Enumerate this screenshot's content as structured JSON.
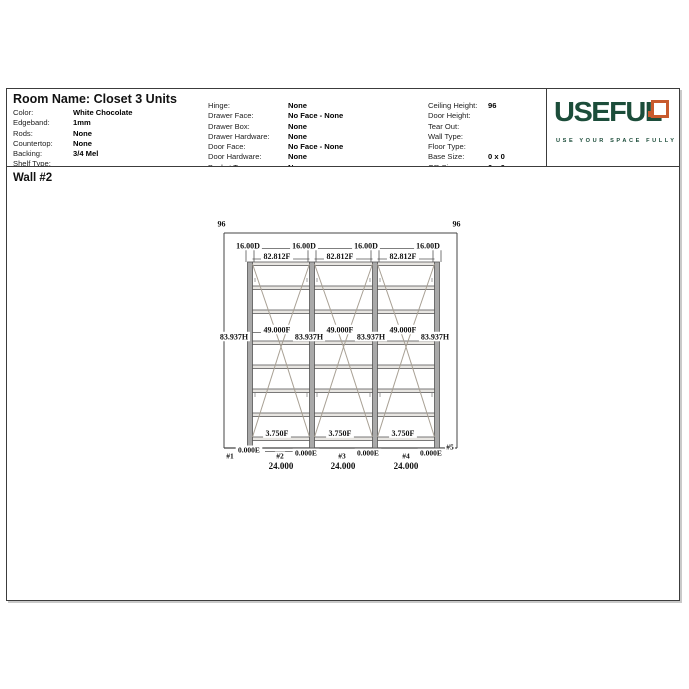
{
  "header": {
    "title": "Room Name: Closet 3 Units",
    "col1": [
      {
        "label": "Color:",
        "value": "White Chocolate"
      },
      {
        "label": "Edgeband:",
        "value": "1mm"
      },
      {
        "label": "Rods:",
        "value": "None"
      },
      {
        "label": "Countertop:",
        "value": "None"
      },
      {
        "label": "Backing:",
        "value": "3/4 Mel"
      },
      {
        "label": "Shelf Type:",
        "value": ""
      }
    ],
    "col2": [
      {
        "label": "Hinge:",
        "value": "None"
      },
      {
        "label": "Drawer Face:",
        "value": "No Face - None"
      },
      {
        "label": "Drawer Box:",
        "value": "None"
      },
      {
        "label": "Drawer Hardware:",
        "value": "None"
      },
      {
        "label": "Door Face:",
        "value": "No Face - None"
      },
      {
        "label": "Door Hardware:",
        "value": "None"
      },
      {
        "label": "Basket Type:",
        "value": "None"
      }
    ],
    "col3": [
      {
        "label": "Ceiling Height:",
        "value": "96"
      },
      {
        "label": "Door Height:",
        "value": ""
      },
      {
        "label": "Tear Out:",
        "value": ""
      },
      {
        "label": "Wall Type:",
        "value": ""
      },
      {
        "label": "Floor Type:",
        "value": ""
      },
      {
        "label": "Base Size:",
        "value": "0 x 0"
      },
      {
        "label": "QR Size:",
        "value": "0 x 0"
      }
    ],
    "logo": {
      "text": "USEFUL",
      "tagline": "USE YOUR SPACE FULLY",
      "green": "#1c4d3a",
      "orange": "#c85a2d"
    }
  },
  "wall": {
    "label": "Wall #2"
  },
  "drawing": {
    "wall_height_labels": [
      "96",
      "96"
    ],
    "depth_labels": [
      "16.00D",
      "16.00D",
      "16.00D",
      "16.00D"
    ],
    "top_shelf_labels": [
      "82.812F",
      "82.812F",
      "82.812F"
    ],
    "mid_shelf_labels": [
      "49.000F",
      "49.000F",
      "49.000F"
    ],
    "panel_height_labels": [
      "83.937H",
      "83.937H",
      "83.937H",
      "83.937H"
    ],
    "toe_labels": [
      "3.750F",
      "3.750F",
      "3.750F"
    ],
    "edge_labels": [
      "0.000E",
      "0.000E",
      "0.000E",
      "0.000E"
    ],
    "panel_numbers": [
      "#1",
      "#2",
      "#3",
      "#4",
      "#5"
    ],
    "unit_widths": [
      "24.000",
      "24.000",
      "24.000"
    ],
    "colors": {
      "line": "#444444",
      "dim_line": "#555555",
      "panel_fill": "#a9a9a9",
      "shelf_fill": "#e8e6e2",
      "diagonal": "#a8a094",
      "label_text": "#111111"
    }
  }
}
